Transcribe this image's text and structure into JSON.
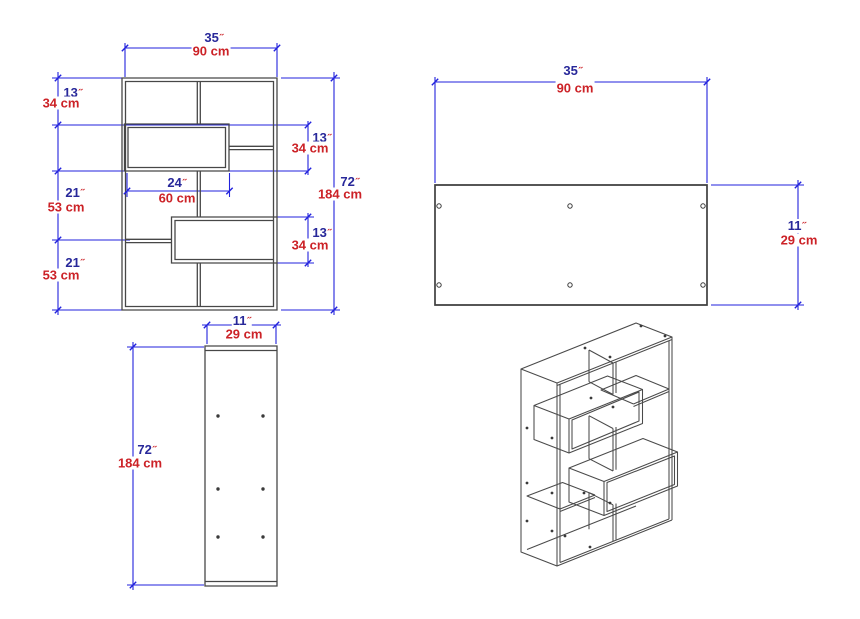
{
  "document": {
    "type": "furniture-technical-drawing",
    "background": "#ffffff"
  },
  "colors": {
    "dimension_line": "#2222dd",
    "inch_text": "#28289a",
    "inch_mark": "#cc2227",
    "cm_text": "#cc2227",
    "drawing_line": "#474747",
    "plan_outline": "#3f3f3f"
  },
  "units": {
    "inch_mark": "˝"
  },
  "views": {
    "front_elevation": {
      "dimensions": [
        "35˝ / 90 cm width",
        "13˝ / 34 cm",
        "21˝ / 53 cm",
        "21˝ / 53 cm",
        "13˝ / 34 cm",
        "13˝ / 34 cm",
        "72˝ / 184 cm height",
        "24˝ / 60 cm"
      ]
    },
    "top_panel_plan": {
      "dimensions": [
        "35˝ / 90 cm width",
        "11˝ / 29 cm depth"
      ],
      "holes": 6
    },
    "side_panel": {
      "dimensions": [
        "11˝ / 29 cm width",
        "72˝ / 184 cm height"
      ],
      "holes": 6
    },
    "isometric": {
      "dimensions": []
    }
  },
  "dim_labels": [
    {
      "view": "front",
      "inch": "35",
      "cm": "90 cm",
      "ix": 214,
      "iy": 38,
      "cx": 211,
      "cy": 51
    },
    {
      "view": "front",
      "inch": "13",
      "cm": "34 cm",
      "ix": 73,
      "iy": 93,
      "cx": 61,
      "cy": 103
    },
    {
      "view": "front",
      "inch": "21",
      "cm": "53 cm",
      "ix": 75,
      "iy": 193,
      "cx": 66,
      "cy": 207
    },
    {
      "view": "front",
      "inch": "21",
      "cm": "53 cm",
      "ix": 75,
      "iy": 263,
      "cx": 61,
      "cy": 275
    },
    {
      "view": "front",
      "inch": "13",
      "cm": "34 cm",
      "ix": 322,
      "iy": 138,
      "cx": 310,
      "cy": 148
    },
    {
      "view": "front",
      "inch": "13",
      "cm": "34 cm",
      "ix": 322,
      "iy": 233,
      "cx": 310,
      "cy": 245
    },
    {
      "view": "front",
      "inch": "72",
      "cm": "184 cm",
      "ix": 350,
      "iy": 182,
      "cx": 340,
      "cy": 194
    },
    {
      "view": "front",
      "inch": "24",
      "cm": "60 cm",
      "ix": 177,
      "iy": 183,
      "cx": 177,
      "cy": 198
    },
    {
      "view": "plan",
      "inch": "35",
      "cm": "90 cm",
      "ix": 573,
      "iy": 71,
      "cx": 575,
      "cy": 88
    },
    {
      "view": "plan",
      "inch": "11",
      "cm": "29 cm",
      "ix": 797,
      "iy": 226,
      "cx": 799,
      "cy": 240
    },
    {
      "view": "side",
      "inch": "11",
      "cm": "29 cm",
      "ix": 242,
      "iy": 321,
      "cx": 244,
      "cy": 334
    },
    {
      "view": "side",
      "inch": "72",
      "cm": "184 cm",
      "ix": 147,
      "iy": 450,
      "cx": 140,
      "cy": 463
    }
  ]
}
